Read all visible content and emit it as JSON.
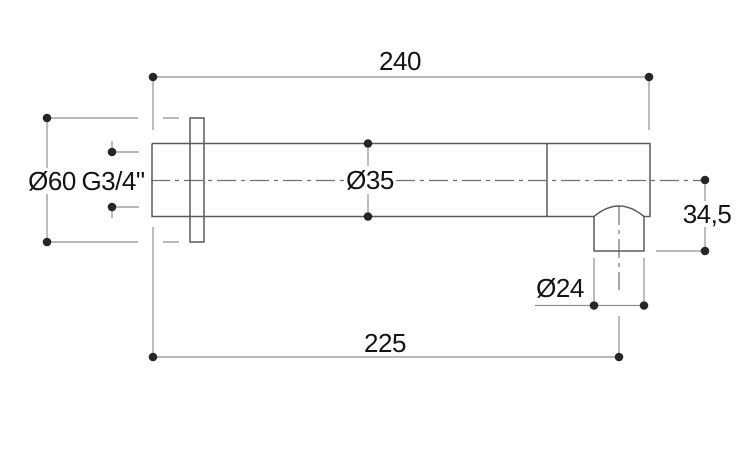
{
  "drawing": {
    "dimensions": {
      "overall_length": "240",
      "wall_to_outlet_center": "225",
      "flange_diameter": "Ø60",
      "thread_size": "G3/4\"",
      "body_diameter": "Ø35",
      "outlet_diameter": "Ø24",
      "outlet_height": "34,5"
    },
    "colors": {
      "background": "#ffffff",
      "object_line": "#5a5a5a",
      "dimension_line": "#8f8f8f",
      "centerline": "#6f6f6f",
      "marker_dot": "#262626",
      "text": "#141414"
    }
  }
}
